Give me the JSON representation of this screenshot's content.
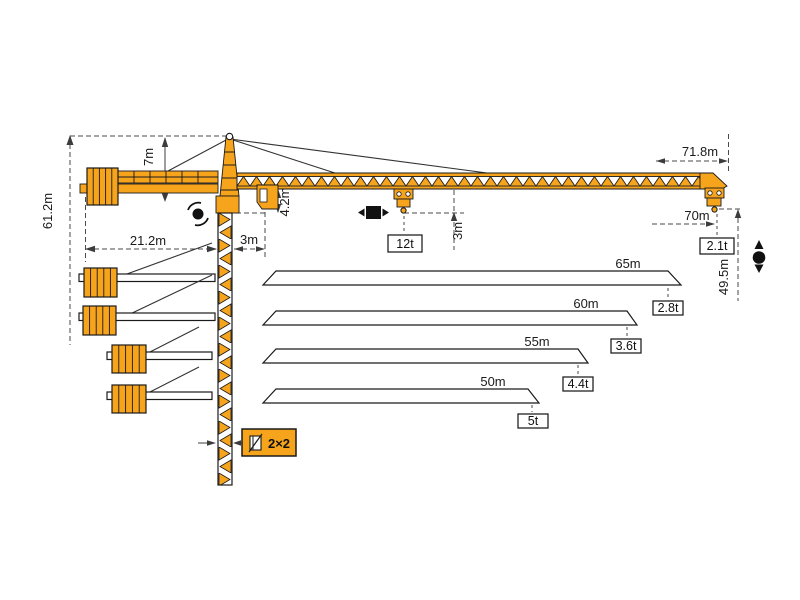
{
  "diagram_title": "tower-crane-working-range-and-load-diagram",
  "colors": {
    "crane_orange": "#F7A41D",
    "outline": "#1A1A1A",
    "dimension_gray": "#3C3C3C",
    "symbol_black": "#111111",
    "background": "#FFFFFF"
  },
  "dims": {
    "total_height": "61.2m",
    "tower_head_height": "7m",
    "counter_jib_radius": "21.2m",
    "jib_foot_offset": "3m",
    "jib_foot_depth": "4.2m",
    "hook_clearance": "3m",
    "max_load": "12t",
    "jib_overall_length": "71.8m",
    "max_working_radius": "70m",
    "tip_load": "2.1t",
    "under_hook_height": "49.5m",
    "mast_section": "2×2"
  },
  "jib_options": [
    {
      "length": "65m",
      "capacity": "2.8t"
    },
    {
      "length": "60m",
      "capacity": "3.6t"
    },
    {
      "length": "55m",
      "capacity": "4.4t"
    },
    {
      "length": "50m",
      "capacity": "5t"
    }
  ],
  "icons": {
    "slewing": "slewing-rotation-icon",
    "trolley": "trolley-travel-icon",
    "hoist": "hoisting-icon",
    "mast_section": "mast-cross-section-icon"
  }
}
